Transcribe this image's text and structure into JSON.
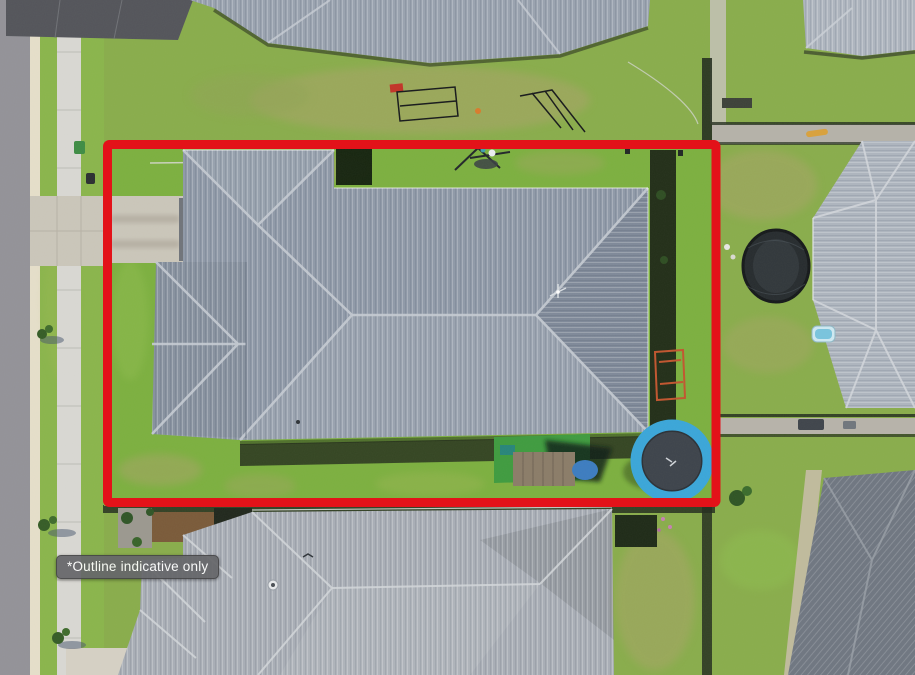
{
  "scene": {
    "type": "aerial-photograph",
    "alt": "Aerial drone view of a suburban house and backyard enclosed by a red property boundary outline",
    "label": "*Outline indicative only"
  },
  "colors": {
    "outline-red": "#e31219",
    "label-bg": "#66676a",
    "label-text": "#ffffff",
    "label-border": "#454547",
    "grass-base": "#89ad4b",
    "lawn": "#7cb03f",
    "verge": "#8ab54b",
    "dry-grass": "#a8a468",
    "road": "#939298",
    "curb": "#e6dfca",
    "sidewalk": "#d9d8d3",
    "driveway": "#cbc6ba",
    "main-roof": "#8f99a8",
    "top-roof": "#99a2af",
    "right-roof": "#aeb5bf",
    "bottom-roof": "#a9aeb6",
    "bottom-right-roof": "#6f7681",
    "dark-pavement": "#53545a",
    "fence-shadow": "#242e1e",
    "trampoline-blue": "#3aa6d9",
    "trampoline-mat": "#3d434b",
    "turf-green": "#3f9b3f",
    "pool-blue": "#79c4de"
  }
}
